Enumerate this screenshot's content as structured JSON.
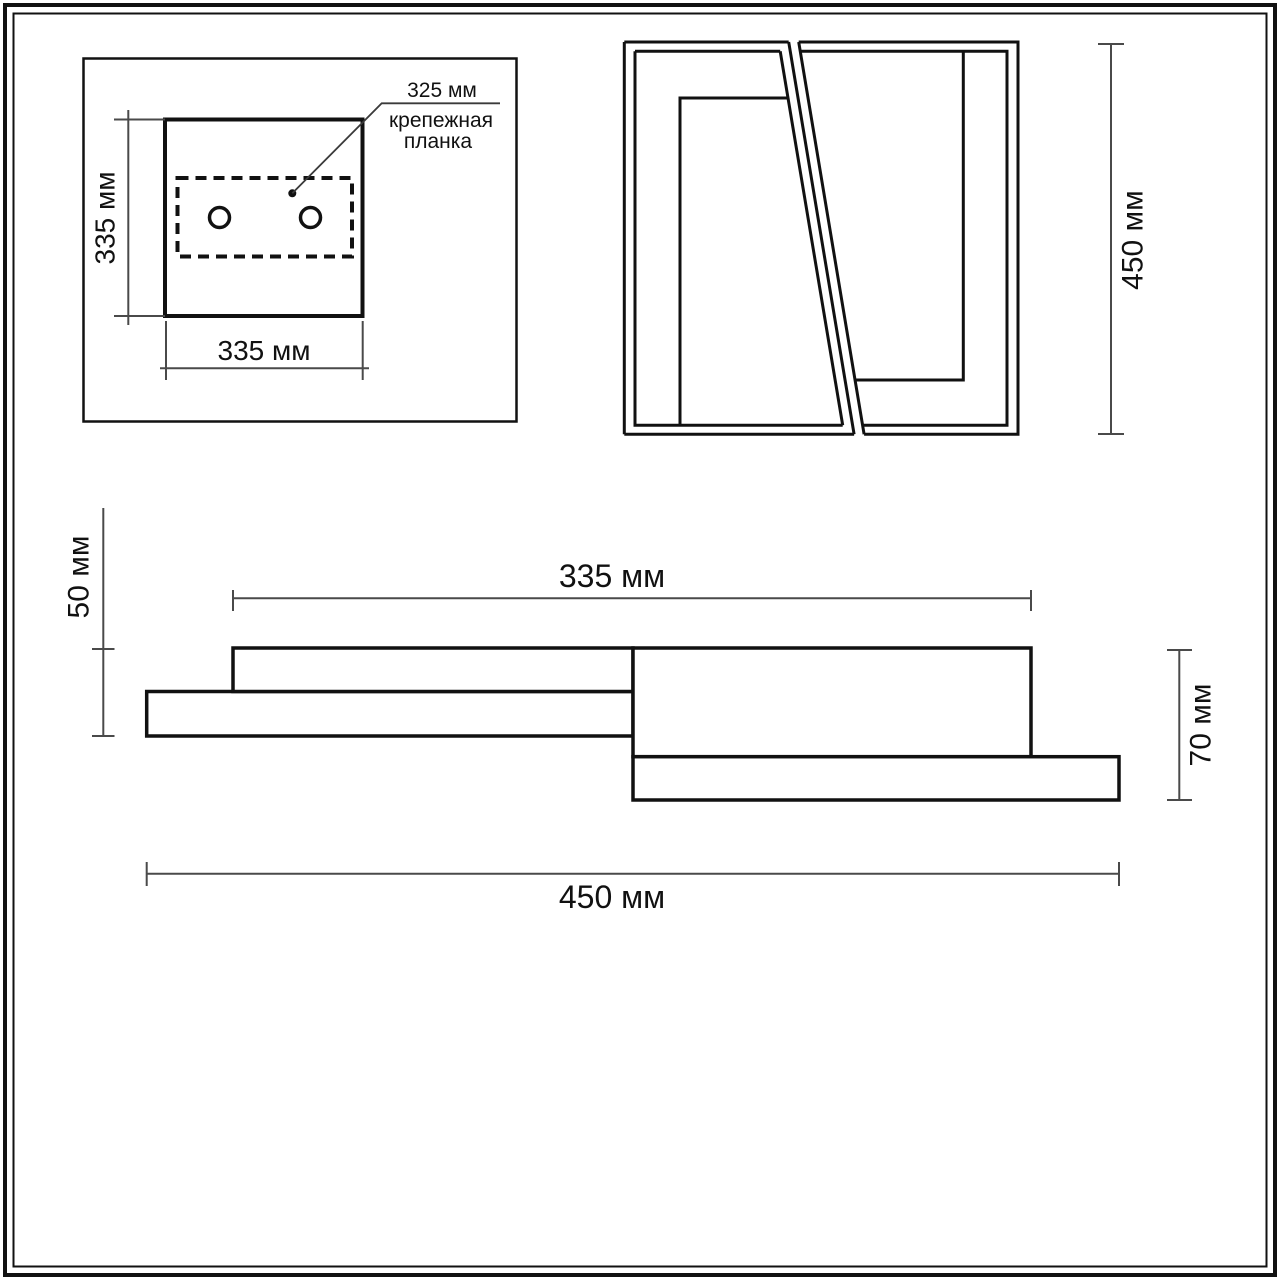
{
  "drawing": {
    "plan_view": {
      "width_label": "335 мм",
      "height_label": "335 мм",
      "callout": {
        "dim_label": "325 мм",
        "name_line1": "крепежная",
        "name_line2": "планка"
      }
    },
    "front_view": {
      "height_label": "450 мм"
    },
    "side_view": {
      "top_width_label": "335 мм",
      "bottom_width_label": "450 мм",
      "left_height_label": "50 мм",
      "right_height_label": "70 мм"
    },
    "colors": {
      "line": "#111111",
      "dimension": "#4a4a4a",
      "background": "#ffffff"
    }
  }
}
